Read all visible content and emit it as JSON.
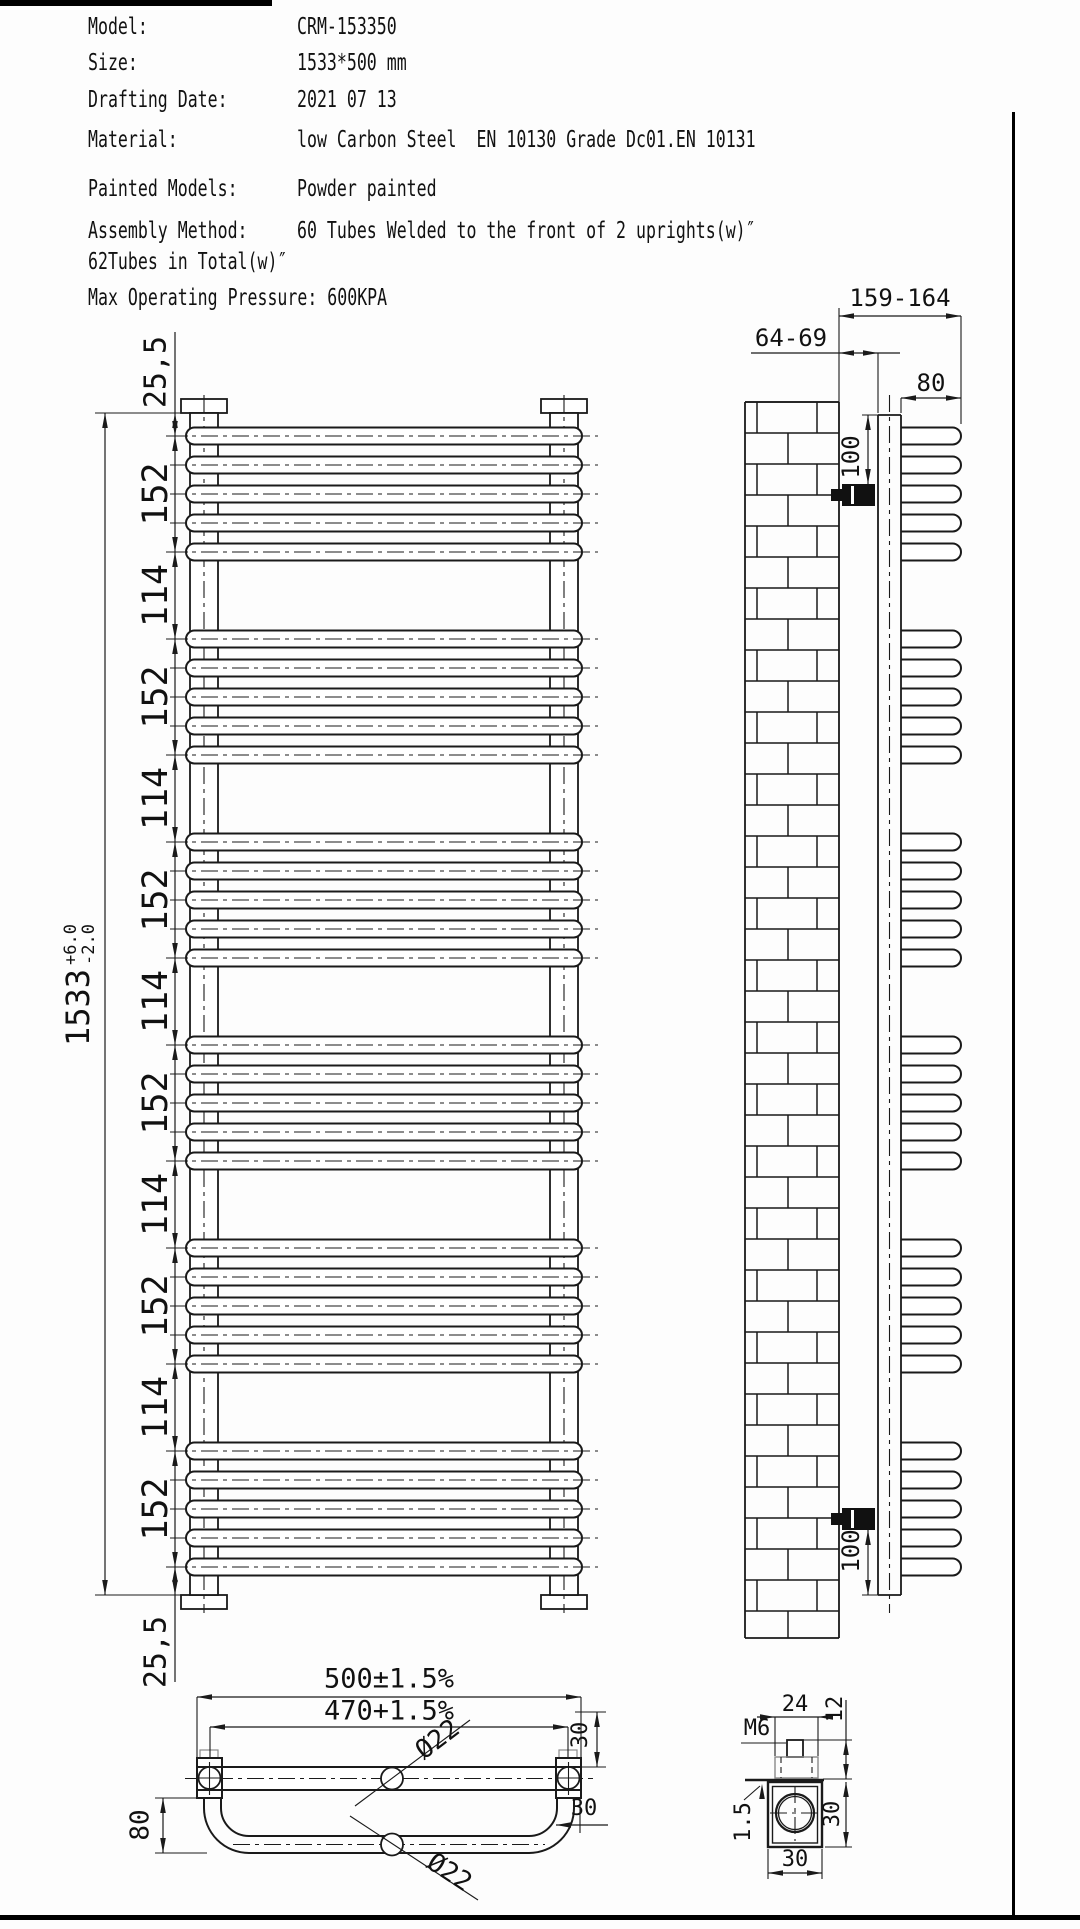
{
  "header": {
    "rows": [
      {
        "label": "Model:",
        "value": "CRM-153350"
      },
      {
        "label": "Size:",
        "value": "1533*500 mm"
      },
      {
        "label": "Drafting Date:",
        "value": "2021 07 13"
      },
      {
        "label": "Material:",
        "value": "low Carbon Steel  EN 10130 Grade Dc01.EN 10131"
      },
      {
        "label": "Painted Models:",
        "value": "Powder painted"
      },
      {
        "label": "Assembly Method:",
        "value": "60 Tubes Welded to the front of 2 uprights(w)″"
      }
    ],
    "note_line": "62Tubes in Total(w)″",
    "pressure_line": "Max Operating Pressure: 600KPA"
  },
  "front_view": {
    "groups": 6,
    "tubes_per_group": 5,
    "total": "1533",
    "total_tol_up": "+6.0",
    "total_tol_dn": "-2.0",
    "segments": [
      "25,5",
      "152",
      "114",
      "152",
      "114",
      "152",
      "114",
      "152",
      "114",
      "152",
      "114",
      "152",
      "25,5"
    ]
  },
  "side_view": {
    "dims": {
      "wall_to_front": "159-164",
      "wall_to_back": "64-69",
      "loop_width": "80",
      "bracket_top": "100",
      "bracket_bottom": "100"
    }
  },
  "top_view": {
    "dims": {
      "overall": "500±1.5%",
      "centers": "470+1.5%",
      "tube_dia_upper": "Ø22",
      "tube_dia_lower": "Ø22",
      "loop_depth": "80",
      "right_upper": "30",
      "right_lower": "30"
    }
  },
  "detail_view": {
    "dims": {
      "thread": "M6",
      "plate_width": "24",
      "head_height": "12",
      "wall_thickness": "1.5",
      "body_height": "30",
      "body_width": "30"
    }
  },
  "colors": {
    "line": "#1a1a1a",
    "text": "#111111",
    "hidden": "#8a8a8a",
    "background": "#fdfdfd"
  }
}
